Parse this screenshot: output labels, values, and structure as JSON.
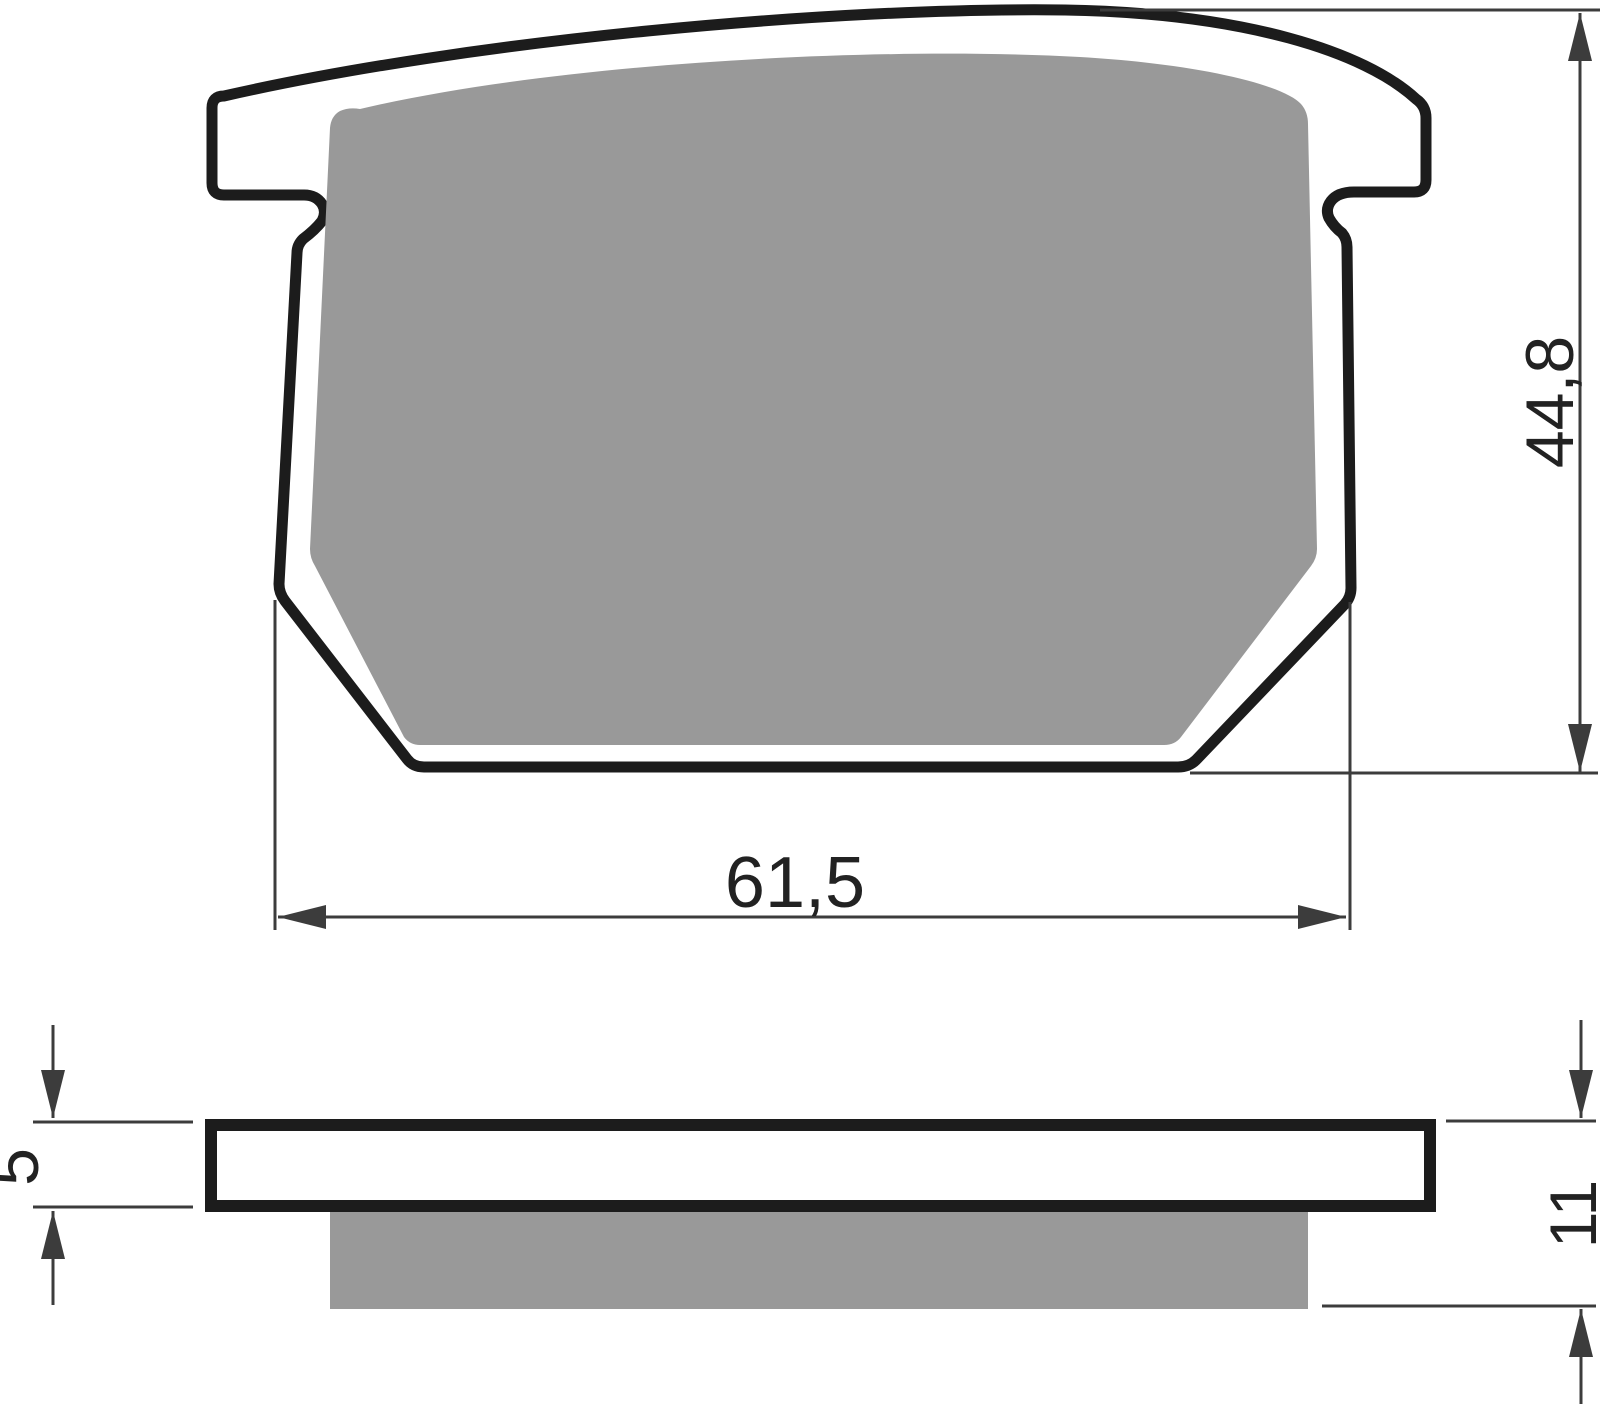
{
  "drawing": {
    "subject": "brake-pad-technical-drawing",
    "front_view": {
      "width_dim": "61,5",
      "height_dim": "44,8"
    },
    "side_view": {
      "plate_thickness_dim": "5",
      "overall_thickness_dim": "11"
    },
    "colors": {
      "outline": "#1c1c1c",
      "friction_material": "#999999",
      "dimension_lines": "#3c3c3c",
      "text": "#222222",
      "background": "#ffffff"
    }
  }
}
